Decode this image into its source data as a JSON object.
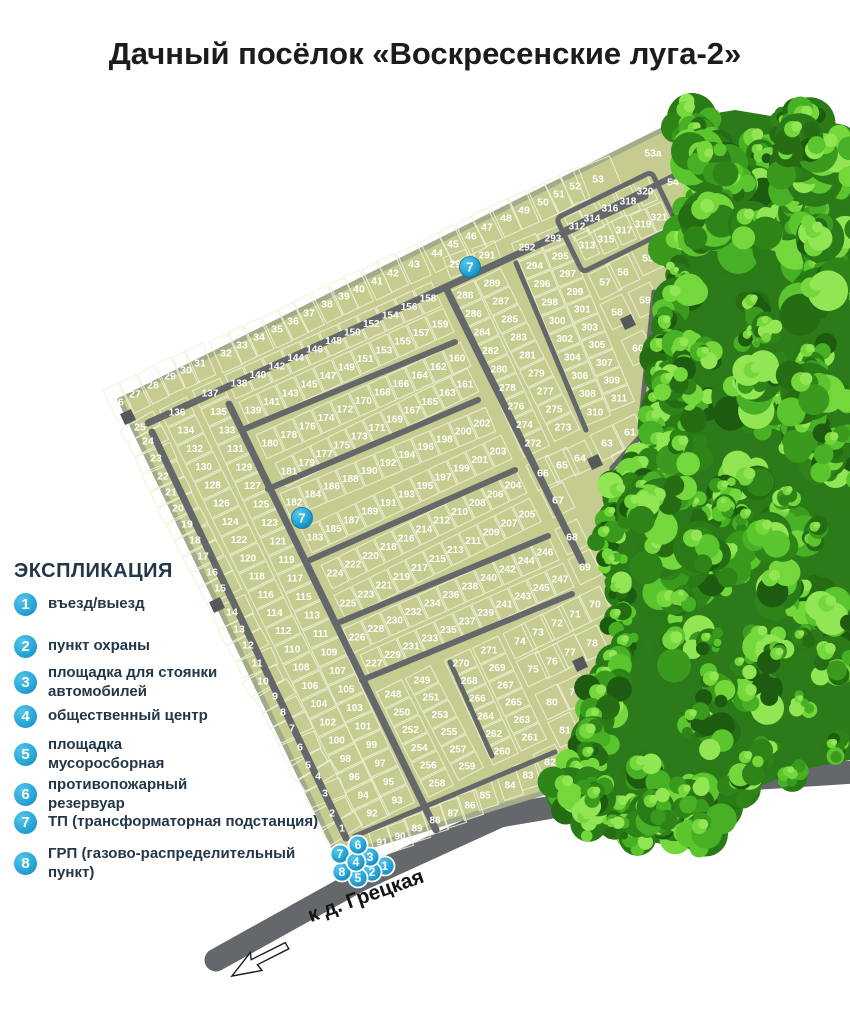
{
  "title": "Дачный посёлок «Воскресенские луга-2»",
  "legend": {
    "heading": "ЭКСПЛИКАЦИЯ",
    "items": [
      {
        "num": "1",
        "label": "въезд/выезд"
      },
      {
        "num": "2",
        "label": "пункт охраны"
      },
      {
        "num": "3",
        "label": "площадка для стоянки\nавтомобилей"
      },
      {
        "num": "4",
        "label": "общественный центр"
      },
      {
        "num": "5",
        "label": "площадка\nмусоросборная"
      },
      {
        "num": "6",
        "label": "противопожарный\nрезервуар"
      },
      {
        "num": "7",
        "label": "ТП  (трансформаторная подстанция)"
      },
      {
        "num": "8",
        "label": "ГРП (газово-распределительный пункт)"
      }
    ]
  },
  "map": {
    "road_label": "к д. Грецкая",
    "markers": {
      "tp": [
        "7",
        "7"
      ],
      "cluster": [
        "1",
        "2",
        "5",
        "8",
        "3",
        "7",
        "4",
        "6"
      ]
    },
    "plot_bands": [
      {
        "id": "edge_nw",
        "numbers": [
          "26",
          "27",
          "28",
          "29",
          "30",
          "31",
          "32",
          "33",
          "34",
          "35",
          "36",
          "37",
          "38",
          "39",
          "40",
          "41",
          "42",
          "43",
          "44",
          "45",
          "46",
          "47",
          "48",
          "49",
          "50",
          "51",
          "52",
          "53",
          "53a",
          "54"
        ]
      },
      {
        "id": "edge_left",
        "numbers": [
          "25",
          "24",
          "23",
          "22",
          "21",
          "20",
          "19",
          "18",
          "17",
          "16",
          "15",
          "14",
          "13",
          "12",
          "11",
          "10",
          "9",
          "8",
          "7",
          "6",
          "5",
          "4",
          "3",
          "2",
          "1"
        ]
      },
      {
        "id": "edge_right",
        "numbers": [
          "55",
          "56",
          "57",
          "58",
          "59",
          "60",
          "61",
          "62",
          "63",
          "64",
          "65",
          "66",
          "67",
          "68",
          "69",
          "70",
          "71",
          "72",
          "73",
          "74",
          "75",
          "76",
          "77",
          "78",
          "79",
          "80",
          "81",
          "82"
        ]
      },
      {
        "id": "edge_bottom",
        "numbers": [
          "83",
          "84",
          "85",
          "86",
          "87",
          "88",
          "89",
          "90",
          "91"
        ]
      },
      {
        "id": "col_west_odd",
        "numbers": [
          "137",
          "135",
          "133",
          "131",
          "129",
          "127",
          "125",
          "123",
          "121",
          "119",
          "117",
          "115",
          "113",
          "111",
          "109",
          "107",
          "105",
          "103",
          "101",
          "99",
          "97",
          "95",
          "93"
        ]
      },
      {
        "id": "col_west_even",
        "numbers": [
          "136",
          "134",
          "132",
          "130",
          "128",
          "126",
          "124",
          "122",
          "120",
          "118",
          "116",
          "114",
          "112",
          "110",
          "108",
          "106",
          "104",
          "102",
          "100",
          "98",
          "96",
          "94",
          "92"
        ]
      },
      {
        "id": "row1_top",
        "numbers": [
          "138",
          "140",
          "142",
          "144",
          "146",
          "148",
          "150",
          "152",
          "154",
          "156",
          "158"
        ]
      },
      {
        "id": "row1_bot",
        "numbers": [
          "139",
          "141",
          "143",
          "145",
          "147",
          "149",
          "151",
          "153",
          "155",
          "157",
          "159"
        ]
      },
      {
        "id": "row2_top",
        "numbers": [
          "180",
          "178",
          "176",
          "174",
          "172",
          "170",
          "168",
          "166",
          "164",
          "162",
          "160"
        ]
      },
      {
        "id": "row2_bot",
        "numbers": [
          "181",
          "179",
          "177",
          "175",
          "173",
          "171",
          "169",
          "167",
          "165",
          "163",
          "161"
        ]
      },
      {
        "id": "row3_top",
        "numbers": [
          "182",
          "184",
          "186",
          "188",
          "190",
          "192",
          "194",
          "196",
          "198",
          "200",
          "202"
        ]
      },
      {
        "id": "row3_bot",
        "numbers": [
          "183",
          "185",
          "187",
          "189",
          "191",
          "193",
          "195",
          "197",
          "199",
          "201",
          "203"
        ]
      },
      {
        "id": "row4_top",
        "numbers": [
          "224",
          "222",
          "220",
          "218",
          "216",
          "214",
          "212",
          "210",
          "208",
          "206",
          "204"
        ]
      },
      {
        "id": "row4_bot",
        "numbers": [
          "225",
          "223",
          "221",
          "219",
          "217",
          "215",
          "213",
          "211",
          "209",
          "207",
          "205"
        ]
      },
      {
        "id": "row5_top",
        "numbers": [
          "226",
          "228",
          "230",
          "232",
          "234",
          "236",
          "238",
          "240",
          "242",
          "244",
          "246"
        ]
      },
      {
        "id": "row5_bot",
        "numbers": [
          "227",
          "229",
          "231",
          "233",
          "235",
          "237",
          "239",
          "241",
          "243",
          "245",
          "247"
        ]
      },
      {
        "id": "col_248",
        "numbers": [
          "248",
          "250",
          "252",
          "254",
          "256",
          "258"
        ]
      },
      {
        "id": "col_249",
        "numbers": [
          "249",
          "251",
          "253",
          "255",
          "257",
          "259"
        ]
      },
      {
        "id": "col_270",
        "numbers": [
          "270",
          "268",
          "266",
          "264",
          "262",
          "260"
        ]
      },
      {
        "id": "col_271",
        "numbers": [
          "271",
          "269",
          "267",
          "265",
          "263",
          "261"
        ]
      },
      {
        "id": "col_288",
        "numbers": [
          "288",
          "286",
          "284",
          "282",
          "280",
          "278",
          "276",
          "274",
          "272"
        ]
      },
      {
        "id": "col_289",
        "numbers": [
          "289",
          "287",
          "285",
          "283",
          "281",
          "279",
          "277",
          "275",
          "273"
        ]
      },
      {
        "id": "pair_290",
        "numbers": [
          "290",
          "291"
        ]
      },
      {
        "id": "col_292",
        "numbers": [
          "292",
          "294",
          "296",
          "298",
          "300",
          "302",
          "304",
          "306",
          "308",
          "310"
        ]
      },
      {
        "id": "col_293",
        "numbers": [
          "293",
          "295",
          "297",
          "299",
          "301",
          "303",
          "305",
          "307",
          "309",
          "311"
        ]
      },
      {
        "id": "block_ne_top",
        "numbers": [
          "312",
          "314",
          "316",
          "318",
          "320"
        ]
      },
      {
        "id": "block_ne_bot",
        "numbers": [
          "313",
          "315",
          "317",
          "319",
          "321"
        ]
      }
    ]
  },
  "colors": {
    "plot_fill": "#c6cb8f",
    "boundary": "#a2ac8b",
    "inner_road": "#64686a",
    "access_road": "#7b7f82",
    "marker_blue": "#29a7d8",
    "legend_text": "#233749"
  }
}
